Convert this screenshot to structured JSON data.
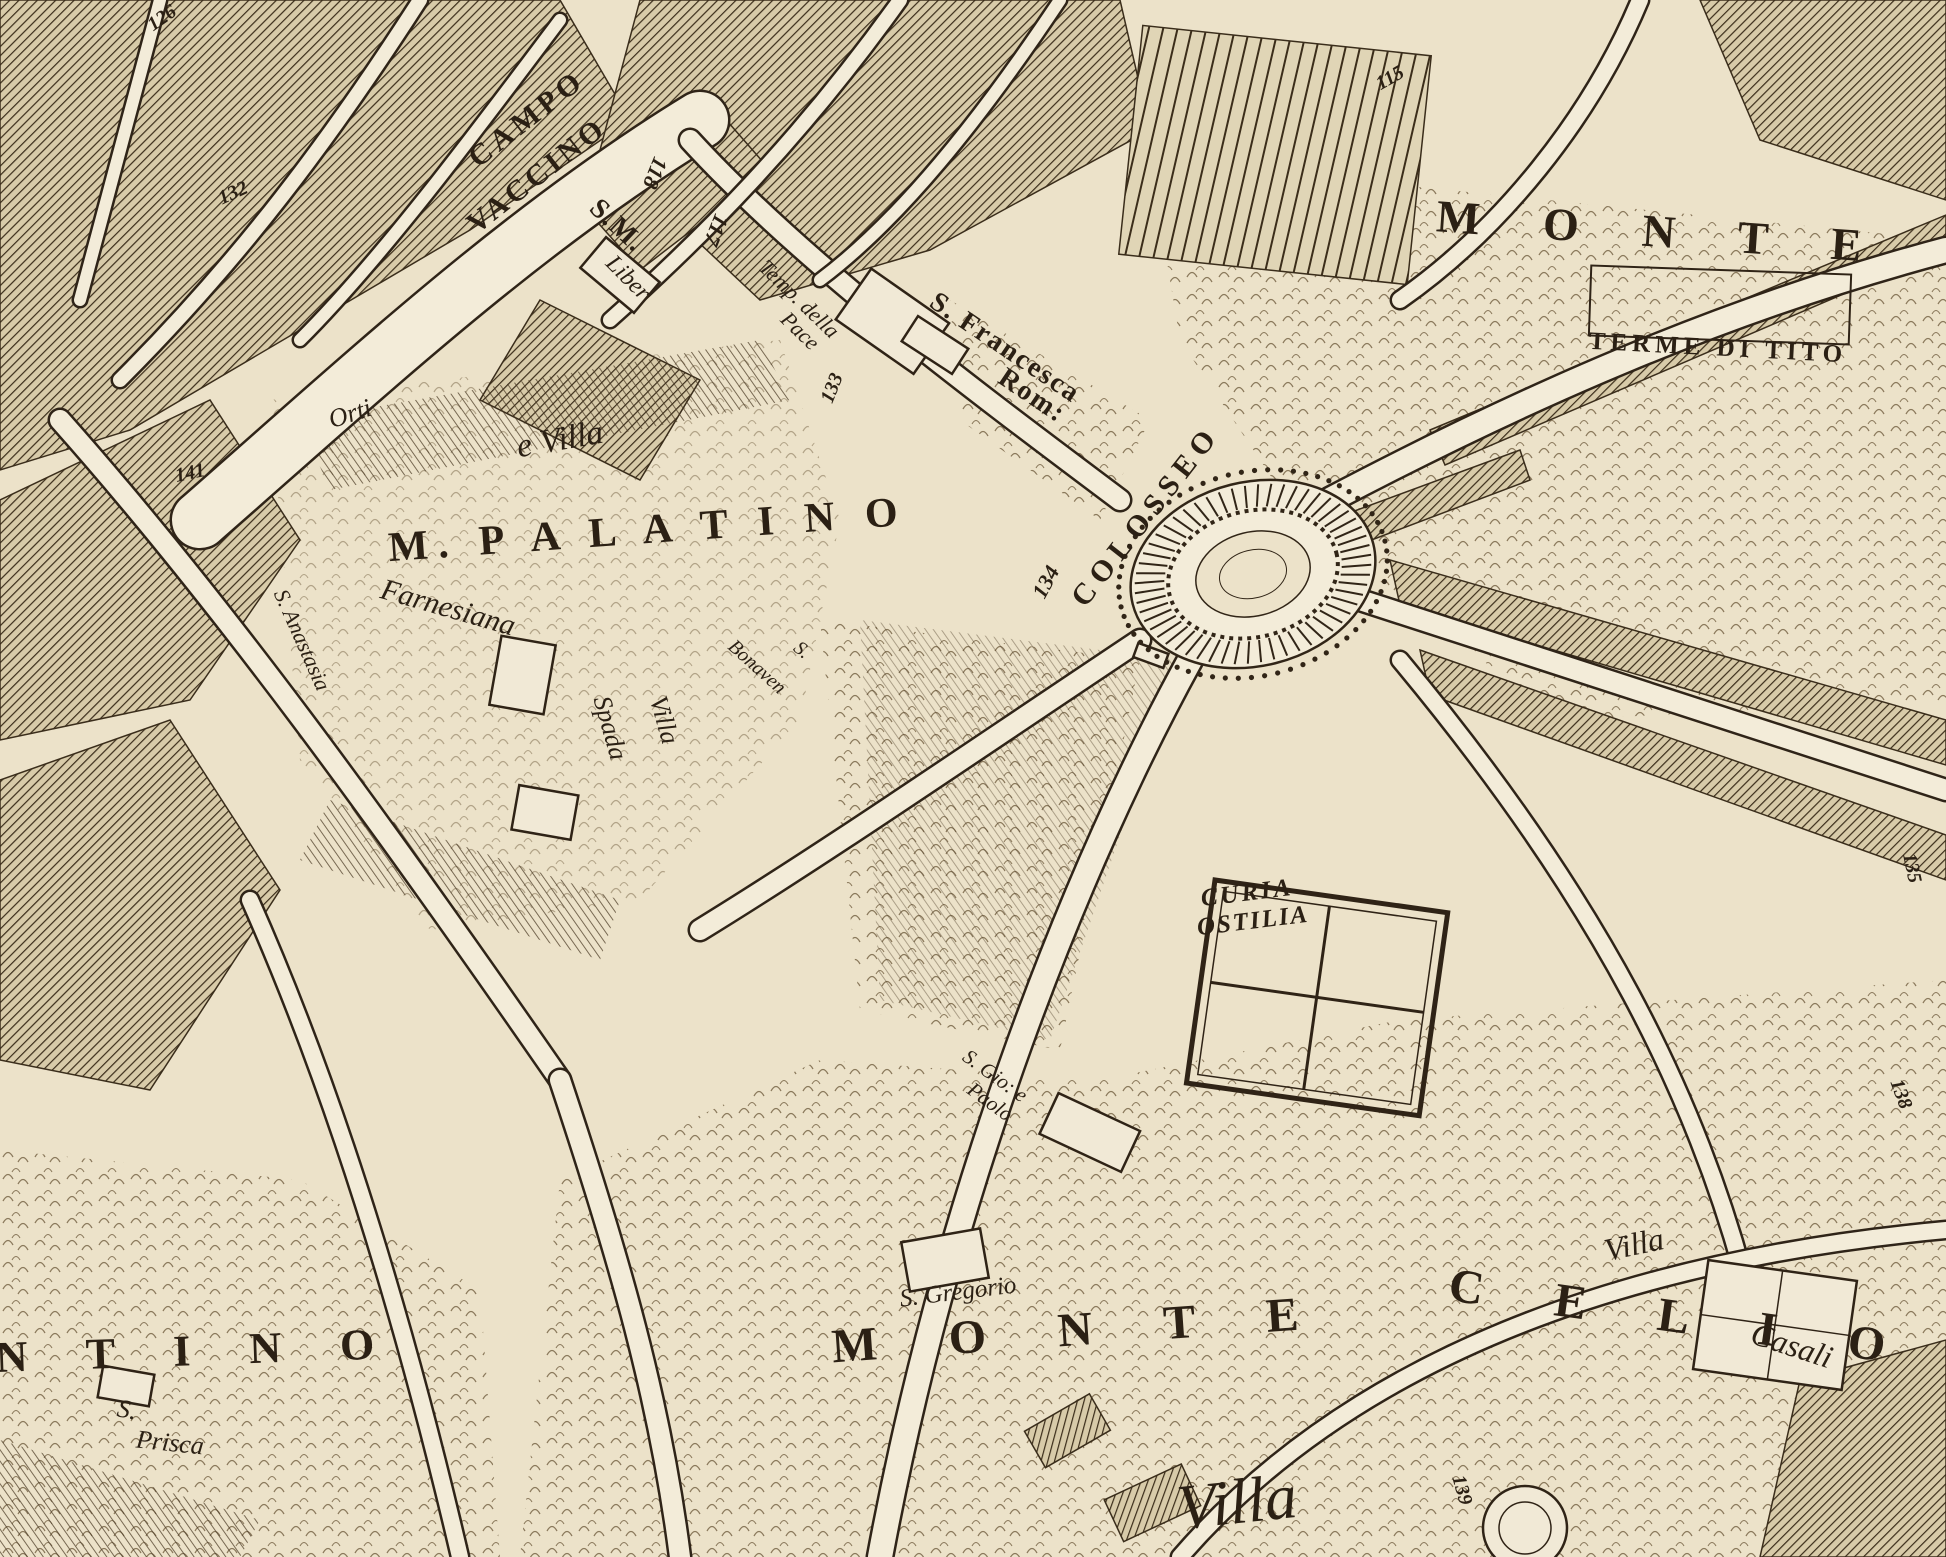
{
  "map": {
    "palette": {
      "parchment": "#ece2c9",
      "street": "#f3ecd9",
      "ink": "#2f2418",
      "hatch": "#3b2d1a"
    },
    "labels": [
      {
        "name": "label-campo",
        "text": "CAMPO",
        "x": 527,
        "y": 119,
        "rot": -38,
        "size": 30,
        "style": "caps",
        "spacing": 5
      },
      {
        "name": "label-vaccino",
        "text": "VACCINO",
        "x": 537,
        "y": 176,
        "rot": -38,
        "size": 30,
        "style": "caps",
        "spacing": 4
      },
      {
        "name": "num-126",
        "text": "126",
        "x": 162,
        "y": 18,
        "rot": -35,
        "size": 20,
        "style": "num"
      },
      {
        "name": "num-132",
        "text": "132",
        "x": 233,
        "y": 193,
        "rot": -25,
        "size": 20,
        "style": "num"
      },
      {
        "name": "num-141",
        "text": "141",
        "x": 190,
        "y": 473,
        "rot": -12,
        "size": 20,
        "style": "num"
      },
      {
        "name": "label-s-m",
        "text": "S.M.",
        "x": 617,
        "y": 226,
        "rot": 43,
        "size": 28,
        "style": "caps",
        "spacing": 2
      },
      {
        "name": "label-liber",
        "text": "Liber",
        "x": 628,
        "y": 278,
        "rot": 45,
        "size": 24,
        "style": "script"
      },
      {
        "name": "num-118",
        "text": "118",
        "x": 655,
        "y": 173,
        "rot": 112,
        "size": 22,
        "style": "num"
      },
      {
        "name": "num-117",
        "text": "117",
        "x": 716,
        "y": 230,
        "rot": 112,
        "size": 22,
        "style": "num"
      },
      {
        "name": "label-temp-della",
        "text": "Temp. della",
        "x": 799,
        "y": 299,
        "rot": 44,
        "size": 22,
        "style": "script"
      },
      {
        "name": "label-pace",
        "text": "Pace",
        "x": 800,
        "y": 331,
        "rot": 44,
        "size": 22,
        "style": "script"
      },
      {
        "name": "num-133",
        "text": "133",
        "x": 832,
        "y": 388,
        "rot": -68,
        "size": 20,
        "style": "num"
      },
      {
        "name": "label-s-francesca",
        "text": "S. Francesca",
        "x": 1005,
        "y": 348,
        "rot": 34,
        "size": 28,
        "style": "caps",
        "spacing": 2
      },
      {
        "name": "label-rom",
        "text": "Rom:",
        "x": 1032,
        "y": 396,
        "rot": 34,
        "size": 28,
        "style": "caps",
        "spacing": 2
      },
      {
        "name": "num-115",
        "text": "115",
        "x": 1390,
        "y": 78,
        "rot": -30,
        "size": 20,
        "style": "num"
      },
      {
        "name": "label-monte-top",
        "text": "M O N T E",
        "x": 1662,
        "y": 232,
        "rot": 4,
        "size": 46,
        "style": "caps",
        "spacing": 26
      },
      {
        "name": "label-terme-di-tito",
        "text": "TERME DI TITO",
        "x": 1718,
        "y": 348,
        "rot": 3,
        "size": 25,
        "style": "caps",
        "spacing": 5
      },
      {
        "name": "label-orti",
        "text": "Orti",
        "x": 350,
        "y": 414,
        "rot": -18,
        "size": 26,
        "style": "script"
      },
      {
        "name": "label-e-villa",
        "text": "e Villa",
        "x": 560,
        "y": 440,
        "rot": -10,
        "size": 34,
        "style": "script"
      },
      {
        "name": "label-m-palatino",
        "text": "M.  P A L A T I N O",
        "x": 648,
        "y": 530,
        "rot": -4,
        "size": 42,
        "style": "caps",
        "spacing": 10
      },
      {
        "name": "label-farnesiana",
        "text": "Farnesiana",
        "x": 448,
        "y": 608,
        "rot": 16,
        "size": 30,
        "style": "script"
      },
      {
        "name": "label-s-anastasia",
        "text": "S. Anastasia",
        "x": 302,
        "y": 640,
        "rot": 66,
        "size": 22,
        "style": "script"
      },
      {
        "name": "label-villa-spada-villa",
        "text": "Villa",
        "x": 664,
        "y": 720,
        "rot": 74,
        "size": 26,
        "style": "script"
      },
      {
        "name": "label-villa-spada-spada",
        "text": "Spada",
        "x": 610,
        "y": 728,
        "rot": 74,
        "size": 26,
        "style": "script"
      },
      {
        "name": "label-s-bonaven-s",
        "text": "S.",
        "x": 802,
        "y": 650,
        "rot": 40,
        "size": 20,
        "style": "script"
      },
      {
        "name": "label-s-bonaven",
        "text": "Bonaven",
        "x": 757,
        "y": 667,
        "rot": 42,
        "size": 20,
        "style": "script"
      },
      {
        "name": "label-colosseo",
        "text": "COLOSSEO",
        "x": 1146,
        "y": 516,
        "rot": -52,
        "size": 30,
        "style": "caps",
        "spacing": 7
      },
      {
        "name": "num-134",
        "text": "134",
        "x": 1046,
        "y": 582,
        "rot": -62,
        "size": 22,
        "style": "num"
      },
      {
        "name": "label-curia",
        "text": "CURIA",
        "x": 1247,
        "y": 893,
        "rot": -7,
        "size": 25,
        "style": "italic-caps",
        "spacing": 3
      },
      {
        "name": "label-ostilia",
        "text": "OSTILIA",
        "x": 1253,
        "y": 921,
        "rot": -7,
        "size": 25,
        "style": "italic-caps",
        "spacing": 2
      },
      {
        "name": "label-s-gio-e",
        "text": "S. Gio: e",
        "x": 995,
        "y": 1076,
        "rot": 36,
        "size": 21,
        "style": "script"
      },
      {
        "name": "label-paolo",
        "text": "Paolo",
        "x": 990,
        "y": 1102,
        "rot": 36,
        "size": 21,
        "style": "script"
      },
      {
        "name": "num-135",
        "text": "135",
        "x": 1912,
        "y": 868,
        "rot": 78,
        "size": 20,
        "style": "num"
      },
      {
        "name": "num-138",
        "text": "138",
        "x": 1901,
        "y": 1094,
        "rot": 70,
        "size": 20,
        "style": "num"
      },
      {
        "name": "label-s-gregorio",
        "text": "S. Gregorio",
        "x": 958,
        "y": 1292,
        "rot": -7,
        "size": 25,
        "style": "script"
      },
      {
        "name": "label-monte-bottom",
        "text": "M O N T E",
        "x": 1080,
        "y": 1330,
        "rot": -4,
        "size": 48,
        "style": "caps",
        "spacing": 30
      },
      {
        "name": "label-celio",
        "text": "C E L I O",
        "x": 1682,
        "y": 1318,
        "rot": 8,
        "size": 48,
        "style": "caps",
        "spacing": 30
      },
      {
        "name": "label-villa-right",
        "text": "Villa",
        "x": 1634,
        "y": 1244,
        "rot": -12,
        "size": 32,
        "style": "script"
      },
      {
        "name": "label-casali",
        "text": "Casali",
        "x": 1792,
        "y": 1345,
        "rot": 18,
        "size": 32,
        "style": "script"
      },
      {
        "name": "label-villa-bottom",
        "text": "Villa",
        "x": 1237,
        "y": 1502,
        "rot": -6,
        "size": 64,
        "style": "script"
      },
      {
        "name": "num-139",
        "text": "139",
        "x": 1462,
        "y": 1490,
        "rot": 74,
        "size": 20,
        "style": "num"
      },
      {
        "name": "label-ntino",
        "text": "N T I N O",
        "x": 197,
        "y": 1351,
        "rot": -2,
        "size": 44,
        "style": "caps",
        "spacing": 24
      },
      {
        "name": "label-s-prisca-s",
        "text": "S.",
        "x": 127,
        "y": 1410,
        "rot": 10,
        "size": 26,
        "style": "script"
      },
      {
        "name": "label-prisca",
        "text": "Prisca",
        "x": 170,
        "y": 1443,
        "rot": 6,
        "size": 26,
        "style": "script"
      }
    ]
  }
}
